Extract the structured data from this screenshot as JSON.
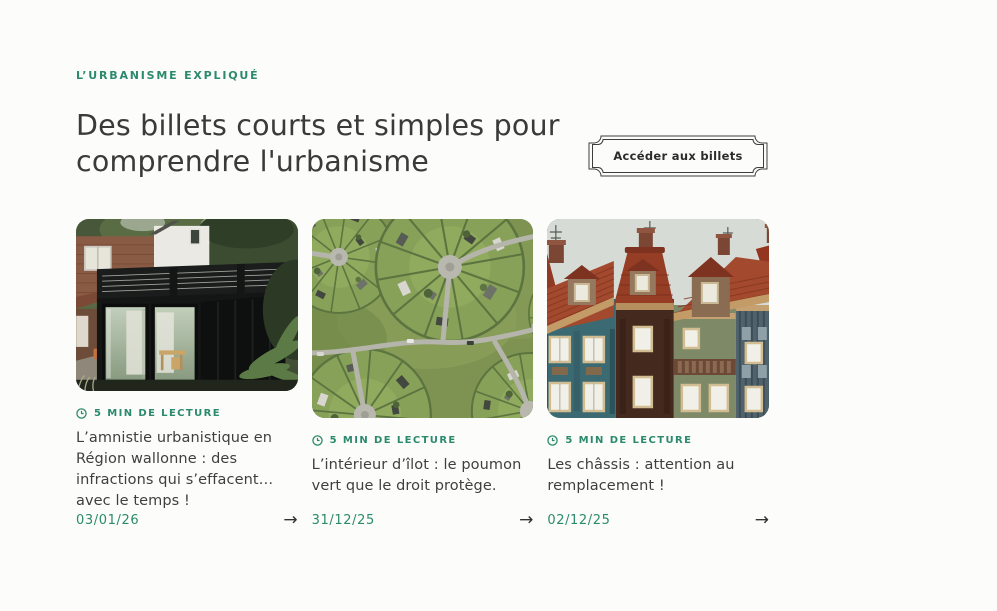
{
  "theme": {
    "accent": "#2b8a6e",
    "page_bg": "#fcfcfa",
    "heading_color": "#3a3a3a"
  },
  "header": {
    "eyebrow": "L’URBANISME EXPLIQUÉ",
    "title_lines": [
      "Des billets courts et simples pour",
      "comprendre l'urbanisme"
    ],
    "cta_label": "Accéder aux billets"
  },
  "ui": {
    "arrow_glyph": "→",
    "icons": {
      "reading_time": "clock-icon",
      "card_link": "arrow-right-icon"
    }
  },
  "articles": [
    {
      "reading_time": "5 MIN DE LECTURE",
      "title": "L’amnistie urbanistique en Région wallonne : des infractions qui s’effacent… avec le temps !",
      "date": "03/01/26"
    },
    {
      "reading_time": "5 MIN DE LECTURE",
      "title": "L’intérieur d’îlot : le poumon vert que le droit protège.",
      "date": "31/12/25"
    },
    {
      "reading_time": "5 MIN DE LECTURE",
      "title": "Les châssis : attention au remplacement !",
      "date": "02/12/25"
    }
  ]
}
